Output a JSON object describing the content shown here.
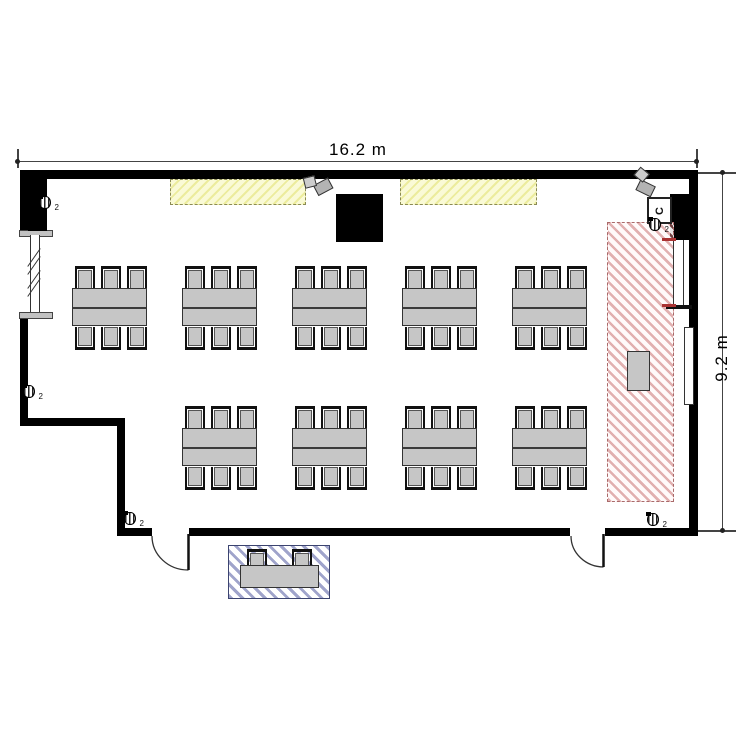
{
  "drawing": {
    "type": "floor-plan",
    "room": "classroom",
    "width_label": "16.2 m",
    "height_label": "9.2 m"
  },
  "labels": {
    "speaker_sub": "2",
    "control_box": "C"
  },
  "furniture": {
    "chairs_per_side": 3,
    "table_rows": [
      {
        "y": 266,
        "xs": [
          72,
          182,
          292,
          402,
          512
        ]
      },
      {
        "y": 406,
        "xs": [
          182,
          292,
          402,
          512
        ]
      }
    ],
    "table": {
      "w": 75,
      "h": 38
    },
    "speaker_count": 5,
    "projector_count": 2
  },
  "colors": {
    "wall": "#000000",
    "furniture_fill": "#c6c6c6",
    "furniture_border": "#333333",
    "light_panel_fill": "#fafad6",
    "light_panel_hatch": "#ecec9d",
    "projection_zone_stripe": "#c97070",
    "projection_zone_border": "#a96a6a",
    "entry_zone_stripe": "#6068a8",
    "dimension_line": "#444444"
  }
}
